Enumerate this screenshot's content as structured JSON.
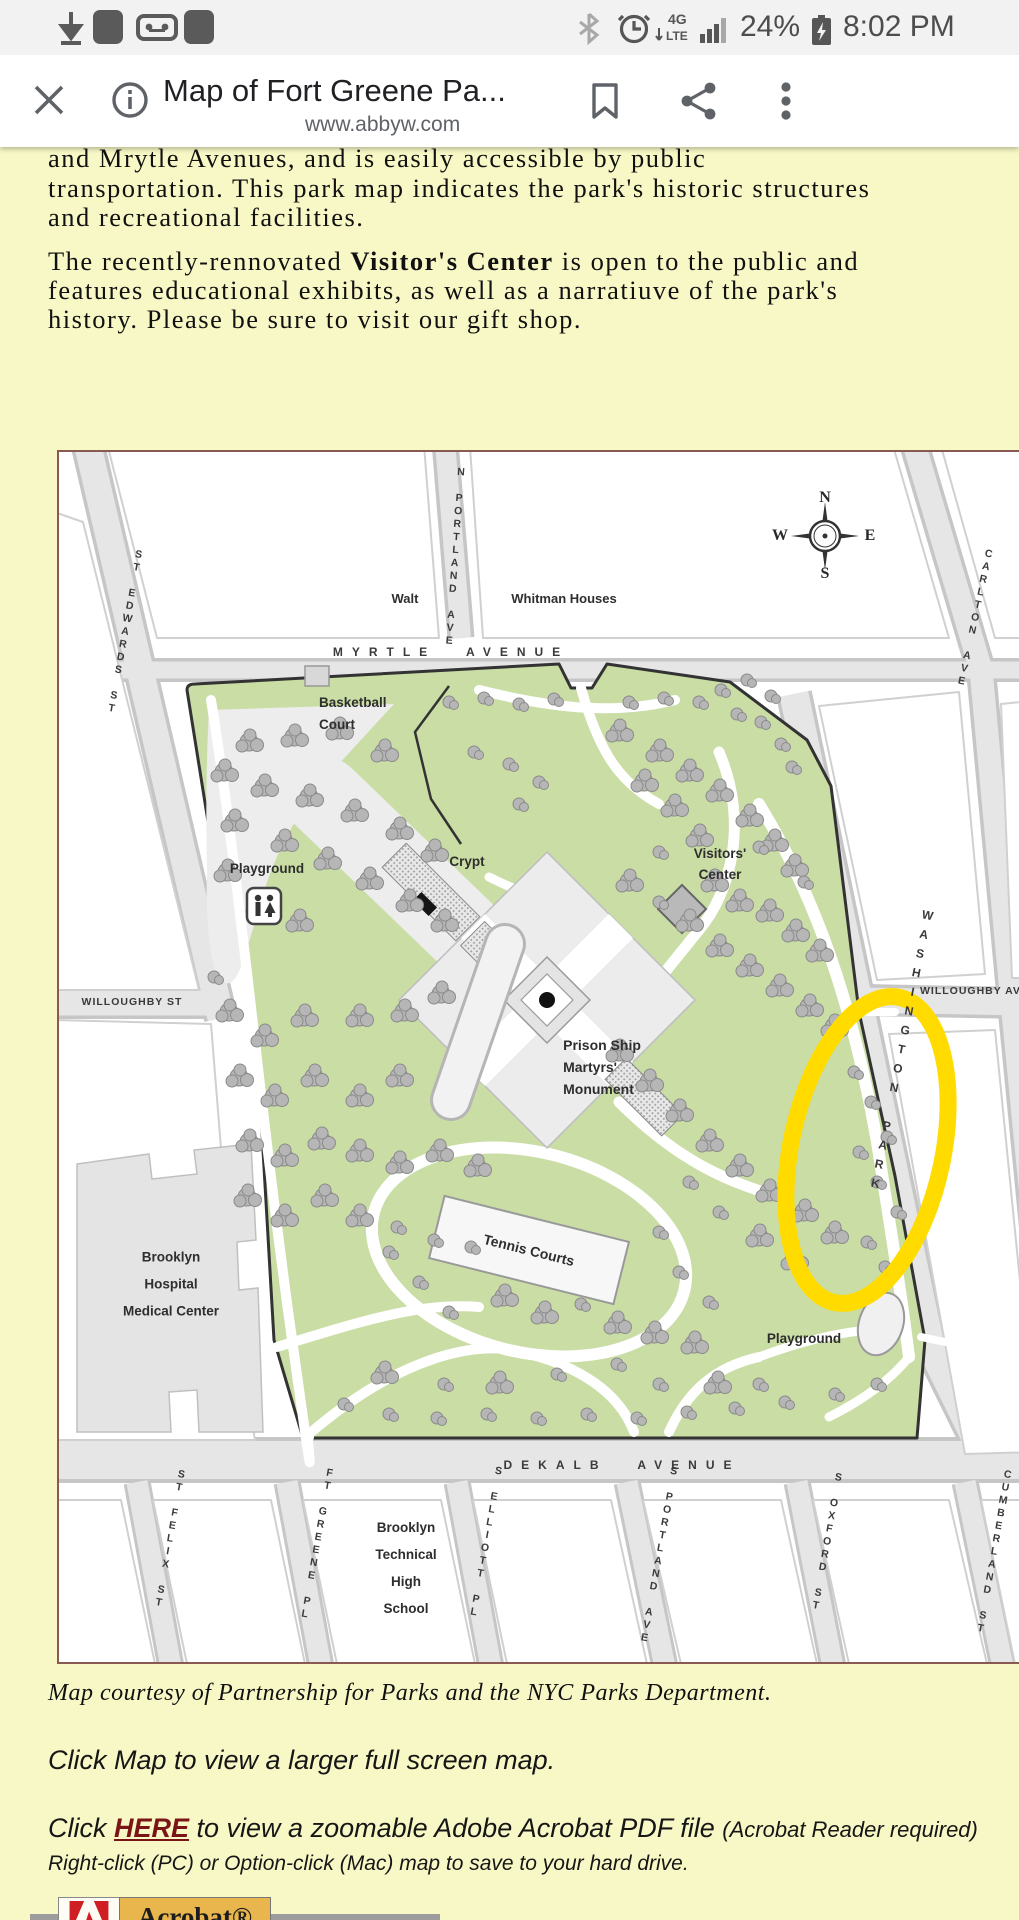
{
  "status_bar": {
    "battery_percent": "24%",
    "time": "8:02 PM"
  },
  "browser": {
    "title": "Map of Fort Greene Pa...",
    "url": "www.abbyw.com"
  },
  "article": {
    "p1_l1": "and Mrytle Avenues, and is easily accessible by public",
    "p1_l2": "transportation. This park map indicates the park's historic structures",
    "p1_l3": "and recreational facilities.",
    "p2_pre": "The recently-rennovated ",
    "p2_bold": "Visitor's Center",
    "p2_post": " is open to the public and",
    "p2_l2": "features educational exhibits, as well as a narratiuve of the park's",
    "p2_l3": "history. Please be sure to visit our gift shop."
  },
  "map": {
    "compass": {
      "n": "N",
      "e": "E",
      "s": "S",
      "w": "W"
    },
    "streets": {
      "st_edwards": "ST EDWARDS ST",
      "n_portland": "N PORTLAND AVE",
      "myrtle": "MYRTLE AVENUE",
      "carlton": "CARLTON AVE",
      "willoughby_st": "WILLOUGHBY ST",
      "willoughby_ave": "WILLOUGHBY AVE",
      "washington_park": "WASHINGTON PARK",
      "dekalb": "DEKALB AVENUE",
      "st_felix": "ST FELIX ST",
      "ft_greene": "FT GREENE PL",
      "s_elliott": "S ELLIOTT PL",
      "s_portland": "S PORTLAND AVE",
      "s_oxford": "S OXFORD ST",
      "cumberland": "CUMBERLAND ST"
    },
    "labels": {
      "walt": "Walt",
      "whitman": "Whitman Houses",
      "basketball_l1": "Basketball",
      "basketball_l2": "Court",
      "playground_nw": "Playground",
      "crypt": "Crypt",
      "visitors_l1": "Visitors'",
      "visitors_l2": "Center",
      "monument_l1": "Prison Ship",
      "monument_l2": "Martyrs'",
      "monument_l3": "Monument",
      "tennis": "Tennis Courts",
      "playground_se": "Playground",
      "hospital_l1": "Brooklyn",
      "hospital_l2": "Hospital",
      "hospital_l3": "Medical Center",
      "school_l1": "Brooklyn",
      "school_l2": "Technical",
      "school_l3": "High",
      "school_l4": "School"
    }
  },
  "captions": {
    "courtesy": "Map courtesy of Partnership for Parks and the NYC Parks Department.",
    "click_map": "Click Map to view a larger full screen map.",
    "click_pre": "Click ",
    "click_link": "HERE",
    "click_post": " to view a zoomable Adobe Acrobat PDF file ",
    "click_note": "(Acrobat Reader required)",
    "right_click": "Right-click (PC) or Option-click (Mac) map to save to your hard drive."
  },
  "badge": {
    "label": "Acrobat®"
  },
  "colors": {
    "page_bg": "#f8f8c6",
    "highlight": "#ffdb00",
    "link_red": "#7b1416",
    "park_green": "#c9dda5"
  }
}
